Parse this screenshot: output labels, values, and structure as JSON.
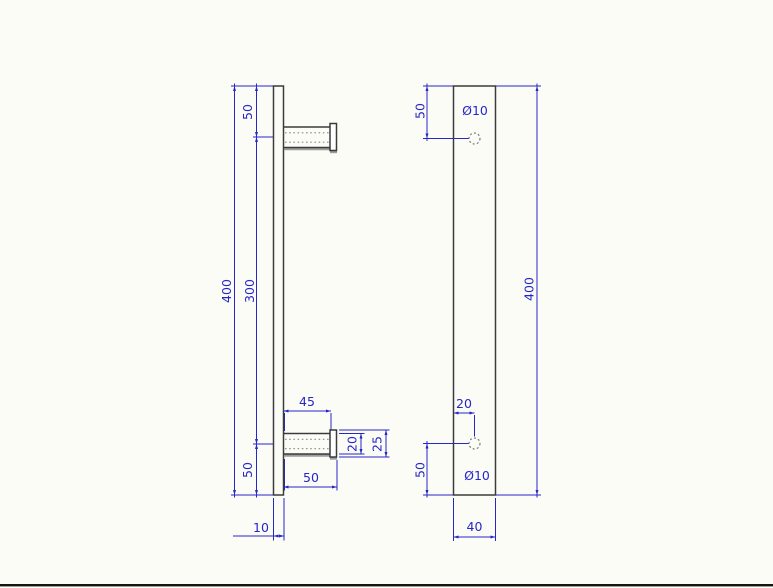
{
  "colors": {
    "dimension": "#2626c9",
    "object_line": "#3b3b3b",
    "hidden_line": "#8a8a8a",
    "shadow_line": "#9c9c9c",
    "background": "#fcfcf7",
    "window_border": "#141414"
  },
  "icons": {
    "hole_symbol": "dotted-circle"
  },
  "side_view": {
    "dims": {
      "length_overall": "400",
      "holes_spacing": "300",
      "top_offset": "50",
      "bottom_offset": "50",
      "post_to_cap": "45",
      "post_overall": "50",
      "post_diameter": "20",
      "cap_diameter": "25",
      "bar_thickness": "10"
    }
  },
  "front_view": {
    "dims": {
      "length_overall": "400",
      "top_offset": "50",
      "bottom_offset": "50",
      "hole_inset": "20",
      "bar_width": "40",
      "hole_top": "Ø10",
      "hole_bottom": "Ø10"
    }
  }
}
